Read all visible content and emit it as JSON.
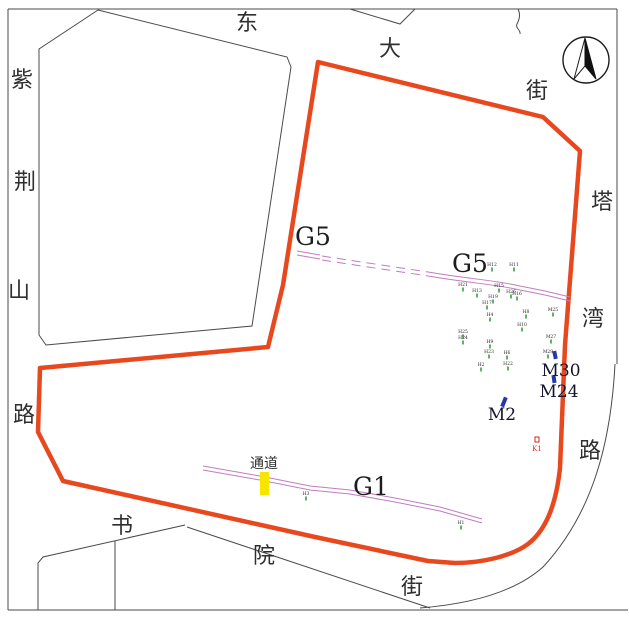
{
  "map": {
    "streets": {
      "top": {
        "name": "东大街",
        "chars": [
          "东",
          "大",
          "街"
        ]
      },
      "left": {
        "name": "紫荆山路",
        "chars": [
          "紫",
          "荆",
          "山",
          "路"
        ]
      },
      "right": {
        "name": "塔湾路",
        "chars": [
          "塔",
          "湾",
          "路"
        ]
      },
      "bottom": {
        "name": "书院街",
        "chars": [
          "书",
          "院",
          "街"
        ]
      }
    },
    "trenches": {
      "g5_label_left": "G5",
      "g5_label_mid": "G5",
      "g1_label": "G1"
    },
    "passage": {
      "label": "通道"
    },
    "tombs": {
      "m30": "M30",
      "m24": "M24",
      "m2": "M2"
    },
    "kiln": {
      "label": "K1"
    },
    "compass": "north-arrow",
    "colors": {
      "boundary_orange": "#e8481e",
      "trench_purple": "#bf7ebf",
      "feature_green": "#3c9e3c",
      "tomb_blue": "#2638a8",
      "passage_yellow": "#f7e500",
      "kiln_red": "#d9251c",
      "road_black": "#4a4a4a"
    },
    "features": {
      "markers": [
        {
          "x": 492,
          "y": 266,
          "label": "H12"
        },
        {
          "x": 514,
          "y": 266,
          "label": "H11"
        },
        {
          "x": 463,
          "y": 286,
          "label": "H21"
        },
        {
          "x": 477,
          "y": 292,
          "label": "H13"
        },
        {
          "x": 499,
          "y": 287,
          "label": "H15"
        },
        {
          "x": 511,
          "y": 293,
          "label": "H26"
        },
        {
          "x": 493,
          "y": 298,
          "label": "H19"
        },
        {
          "x": 487,
          "y": 304,
          "label": "H17"
        },
        {
          "x": 517,
          "y": 295,
          "label": "H16"
        },
        {
          "x": 490,
          "y": 316,
          "label": "H4"
        },
        {
          "x": 526,
          "y": 313,
          "label": "H8"
        },
        {
          "x": 522,
          "y": 326,
          "label": "H10"
        },
        {
          "x": 553,
          "y": 311,
          "label": "M25"
        },
        {
          "x": 463,
          "y": 333,
          "label": "H25"
        },
        {
          "x": 463,
          "y": 339,
          "label": "H24"
        },
        {
          "x": 490,
          "y": 343,
          "label": "H9"
        },
        {
          "x": 551,
          "y": 338,
          "label": "M27"
        },
        {
          "x": 489,
          "y": 353,
          "label": "H23"
        },
        {
          "x": 507,
          "y": 354,
          "label": "H6"
        },
        {
          "x": 548,
          "y": 353,
          "label": "M29"
        },
        {
          "x": 481,
          "y": 366,
          "label": "H2"
        },
        {
          "x": 508,
          "y": 365,
          "label": "H22"
        },
        {
          "x": 306,
          "y": 495,
          "label": "H3"
        },
        {
          "x": 461,
          "y": 524,
          "label": "H1"
        }
      ]
    }
  }
}
